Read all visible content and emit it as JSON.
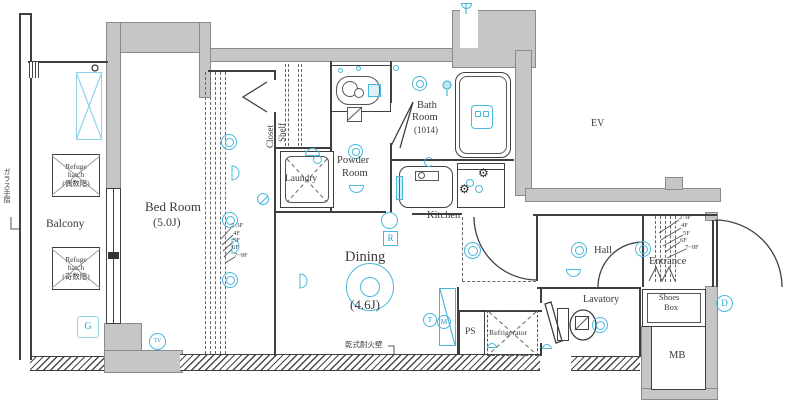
{
  "plan": {
    "rooms": {
      "balcony": {
        "label": "Balcony"
      },
      "bedroom": {
        "label": "Bed Room",
        "size": "(5.0J)"
      },
      "closet": {
        "label": "Closet",
        "shelf": "Shelf"
      },
      "laundry": {
        "label": "Laundry"
      },
      "powder": {
        "line1": "Powder",
        "line2": "Room"
      },
      "bath": {
        "line1": "Bath",
        "line2": "Room",
        "size": "(1014)"
      },
      "kitchen": {
        "label": "Kitchen"
      },
      "dining": {
        "label": "Dining",
        "size": "(4.6J)"
      },
      "hall": {
        "label": "Hall"
      },
      "entrance": {
        "label": "Entrance"
      },
      "lavatory": {
        "label": "Lavatory"
      },
      "shoes_box": {
        "line1": "Shoes",
        "line2": "Box"
      },
      "mb": {
        "label": "MB"
      },
      "ev": {
        "label": "EV"
      },
      "ps": {
        "label": "PS"
      },
      "refrigerator": {
        "label": "Refrigerator"
      }
    },
    "annotations": {
      "glass_rail": "ガラス手摺",
      "dry_firewall": "乾式耐火壁",
      "refuge_even": {
        "line1": "Refuge",
        "line2": "hatch",
        "line3": "(偶数階)"
      },
      "refuge_odd": {
        "line1": "Refuge",
        "line2": "hatch",
        "line3": "(奇数階)"
      },
      "floors": [
        "2·3F",
        "4F",
        "5F",
        "6F",
        "7~9F"
      ]
    },
    "badges": {
      "g": "G",
      "tv": "TV",
      "r": "R",
      "t": "T",
      "m": "M",
      "d": "D"
    },
    "icons": {
      "burner": "⚙"
    },
    "colors": {
      "icon_blue": "#49b8dd",
      "wall_gray": "#c6c6c6",
      "line": "#3f3f3f"
    }
  }
}
